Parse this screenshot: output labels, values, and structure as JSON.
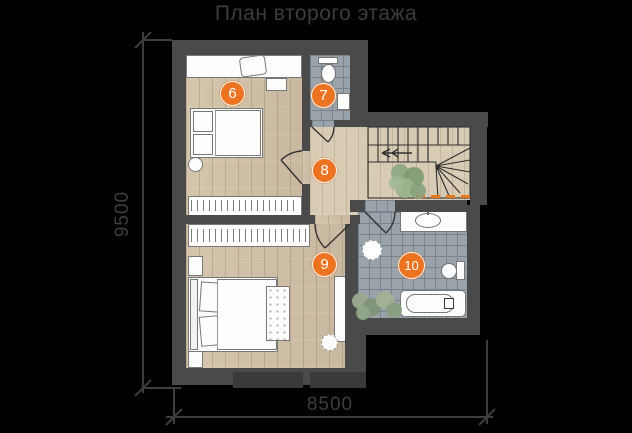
{
  "title": "План второго этажа",
  "dimensions": {
    "vertical": "9500",
    "horizontal": "8500"
  },
  "rooms": [
    {
      "number": "6"
    },
    {
      "number": "7"
    },
    {
      "number": "8"
    },
    {
      "number": "9"
    },
    {
      "number": "10"
    }
  ],
  "colors": {
    "background": "#000000",
    "wall": "#4a4a4a",
    "wood_floor": "#d3c2a8",
    "tile_floor": "#9aa2aa",
    "marker_orange": "#ed7320",
    "annotation_gray": "#3d3d3d",
    "plant_green": "#8ea583"
  }
}
